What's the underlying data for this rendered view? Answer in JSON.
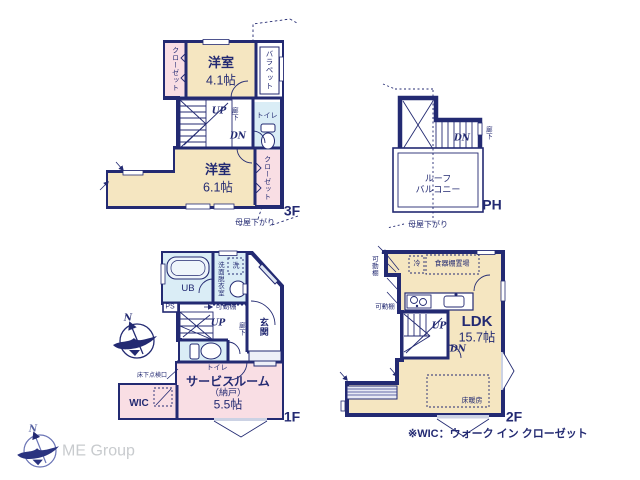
{
  "colors": {
    "wall": "#232a72",
    "room_cream": "#f5e6c1",
    "room_pink": "#f9dee4",
    "room_blue": "#daedf6",
    "logo_text": "#c8cbce"
  },
  "floor_3f": {
    "label": "3F",
    "closet_left": "クローゼット",
    "room1_name": "洋室",
    "room1_size": "4.1帖",
    "parapet": "バラペット",
    "up": "UP",
    "hallway": "廊下",
    "dn": "DN",
    "toilet": "トイレ",
    "room2_name": "洋室",
    "room2_size": "6.1帖",
    "closet_right": "クローゼット",
    "note": "母屋下がり"
  },
  "floor_ph": {
    "label": "PH",
    "dn": "DN",
    "hallway": "廊下",
    "balcony_line1": "ルーフ",
    "balcony_line2": "バルコニー",
    "note": "母屋下がり"
  },
  "floor_1f": {
    "label": "1F",
    "ub": "UB",
    "washroom": "洗面脱衣室",
    "washer": "洗",
    "ps": "PS",
    "shelf": "可動棚",
    "up": "UP",
    "hallway": "廊下",
    "entrance": "玄関",
    "toilet": "トイレ",
    "service_name": "サービスルーム",
    "service_sub": "（納戸）",
    "service_size": "5.5帖",
    "wic": "WIC",
    "floor_hatch": "床下点検口",
    "compass_n": "N"
  },
  "floor_2f": {
    "label": "2F",
    "shelf_top": "可動棚",
    "fridge": "冷",
    "cupboard": "食器棚置場",
    "shelf_mid": "可動棚",
    "up": "UP",
    "dn": "DN",
    "ldk": "LDK",
    "ldk_size": "15.7帖",
    "floor_heating": "床暖房"
  },
  "footer": {
    "wic_note": "※WIC：ウォーク イン クローゼット",
    "logo_text": "ME Group",
    "logo_n": "N"
  }
}
